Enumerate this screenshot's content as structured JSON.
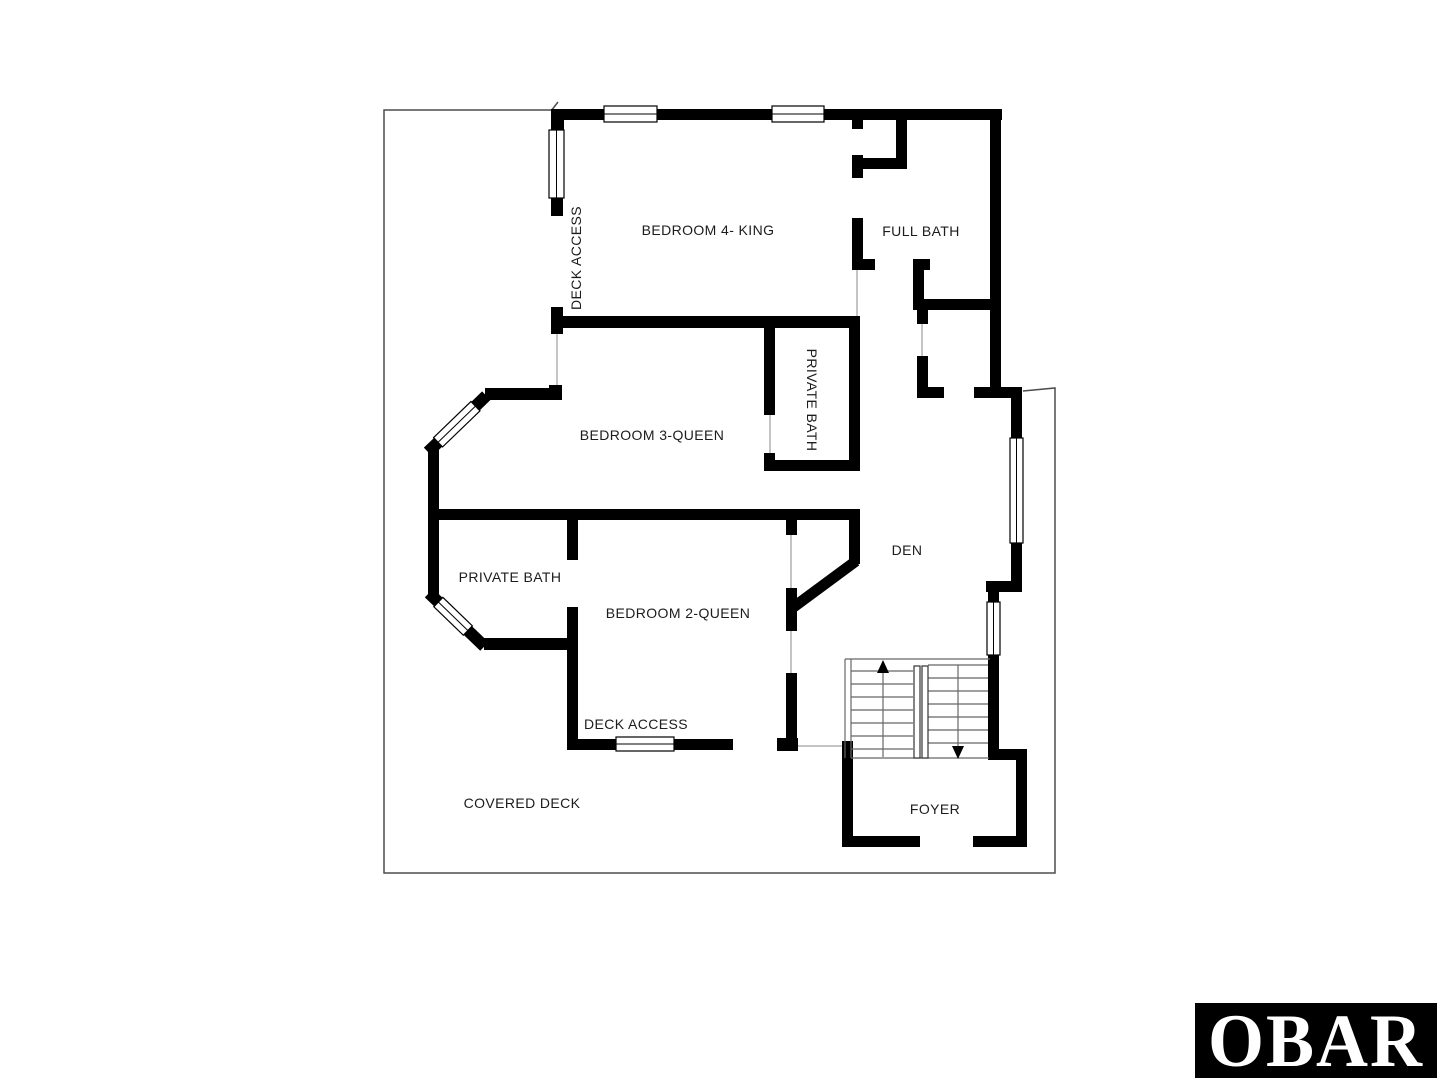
{
  "plan": {
    "labels": {
      "bedroom4": "BEDROOM 4- KING",
      "full_bath": "FULL BATH",
      "deck_access_upper": "DECK ACCESS",
      "private_bath_bed3": "PRIVATE BATH",
      "bedroom3": "BEDROOM 3-QUEEN",
      "private_bath_bed2": "PRIVATE BATH",
      "bedroom2": "BEDROOM 2-QUEEN",
      "den": "DEN",
      "deck_access_lower": "DECK ACCESS",
      "covered_deck": "COVERED DECK",
      "foyer": "FOYER"
    },
    "colors": {
      "wall": "#000000",
      "deck_outline": "#4d4d4d",
      "label_text": "#1c1c1c",
      "background": "#ffffff"
    }
  },
  "logo": {
    "text": "OBAR",
    "background": "#000000",
    "color": "#ffffff"
  }
}
